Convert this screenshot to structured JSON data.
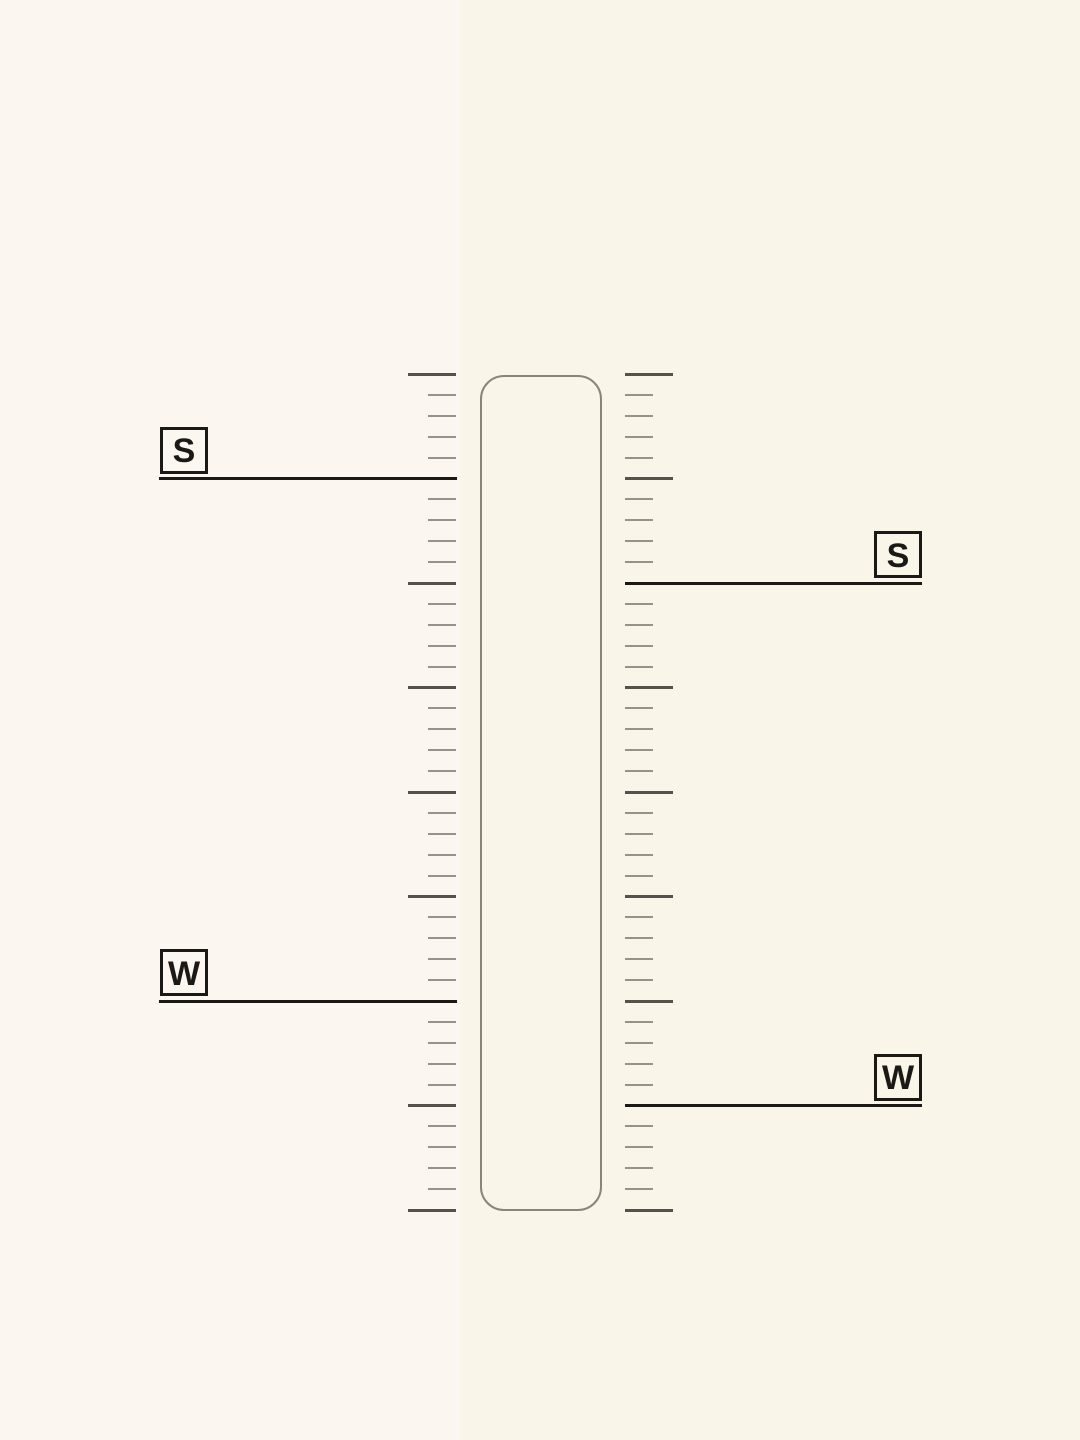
{
  "colors": {
    "bg_left": "#fbf6ef",
    "bg_right": "#faf5e9",
    "tick_short": "#97928a",
    "tick_long": "#56524b",
    "track_border": "#8b8579",
    "ink": "#1b1916"
  },
  "track": {
    "x": 480,
    "y": 375,
    "width": 122,
    "height": 836,
    "radius": 24
  },
  "ruler": {
    "top_y": 374,
    "bottom_y": 1210,
    "tick_count": 41,
    "long_every": 5,
    "short_len": 28,
    "long_len": 48,
    "left_ruler_inner_x": 456,
    "right_ruler_inner_x": 625
  },
  "pointer_geometry": {
    "left_line_x1": 159,
    "left_line_x2": 457,
    "right_line_x1": 625,
    "right_line_x2": 922,
    "box_width": 48,
    "box_height": 47,
    "left_box_x": 160,
    "right_box_x": 874,
    "box_offset_above_line": 52
  },
  "pointers": [
    {
      "id": "pointer-left-s",
      "side": "left",
      "label": "S",
      "tick_index": 5
    },
    {
      "id": "pointer-right-s",
      "side": "right",
      "label": "S",
      "tick_index": 10
    },
    {
      "id": "pointer-left-w",
      "side": "left",
      "label": "W",
      "tick_index": 30
    },
    {
      "id": "pointer-right-w",
      "side": "right",
      "label": "W",
      "tick_index": 35
    }
  ]
}
